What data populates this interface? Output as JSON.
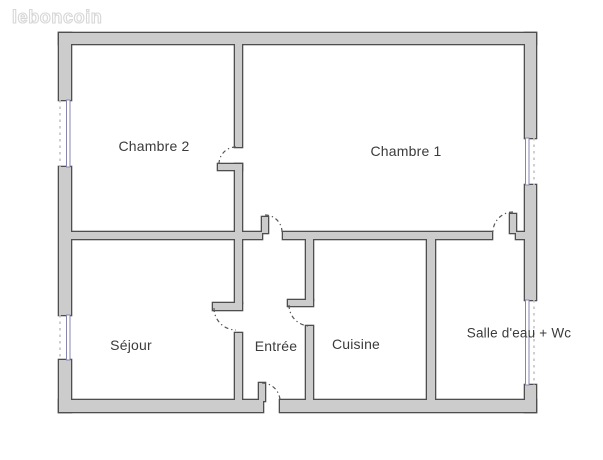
{
  "watermark": {
    "text": "leboncoin"
  },
  "colors": {
    "background": "#ffffff",
    "wall_fill": "#cccccc",
    "wall_stroke": "#4e4e4e",
    "window_line": "#8585b0",
    "window_dash": "#c3c3cb",
    "door_arc": "#555555",
    "label_text": "#3b3b3b"
  },
  "floorplan": {
    "canvas": {
      "width": 603,
      "height": 460
    },
    "rooms": [
      {
        "id": "chambre2",
        "label": "Chambre 2"
      },
      {
        "id": "chambre1",
        "label": "Chambre 1"
      },
      {
        "id": "sejour",
        "label": "Séjour"
      },
      {
        "id": "entree",
        "label": "Entrée"
      },
      {
        "id": "cuisine",
        "label": "Cuisine"
      },
      {
        "id": "salle-deau-wc",
        "label": "Salle d'eau + Wc"
      }
    ],
    "walls": [
      {
        "x": 59,
        "y": 33,
        "w": 477,
        "h": 11
      },
      {
        "x": 59,
        "y": 33,
        "w": 12,
        "h": 67
      },
      {
        "x": 59,
        "y": 167,
        "w": 12,
        "h": 148
      },
      {
        "x": 59,
        "y": 360,
        "w": 12,
        "h": 52
      },
      {
        "x": 525,
        "y": 33,
        "w": 11,
        "h": 105
      },
      {
        "x": 525,
        "y": 185,
        "w": 11,
        "h": 115
      },
      {
        "x": 525,
        "y": 385,
        "w": 11,
        "h": 27
      },
      {
        "x": 59,
        "y": 400,
        "w": 204,
        "h": 12
      },
      {
        "x": 280,
        "y": 400,
        "w": 256,
        "h": 12
      },
      {
        "x": 70,
        "y": 232,
        "w": 192,
        "h": 7
      },
      {
        "x": 283,
        "y": 232,
        "w": 209,
        "h": 7
      },
      {
        "x": 516,
        "y": 232,
        "w": 10,
        "h": 7
      },
      {
        "x": 235,
        "y": 43,
        "w": 7,
        "h": 104
      },
      {
        "x": 235,
        "y": 164,
        "w": 7,
        "h": 75
      },
      {
        "x": 235,
        "y": 238,
        "w": 7,
        "h": 65
      },
      {
        "x": 235,
        "y": 333,
        "w": 7,
        "h": 69
      },
      {
        "x": 306,
        "y": 238,
        "w": 7,
        "h": 62
      },
      {
        "x": 306,
        "y": 326,
        "w": 7,
        "h": 76
      },
      {
        "x": 427,
        "y": 238,
        "w": 8,
        "h": 164
      }
    ],
    "door_leaves": [
      {
        "x": 218,
        "y": 164,
        "w": 24,
        "h": 6
      },
      {
        "x": 262,
        "y": 217,
        "w": 6,
        "h": 16
      },
      {
        "x": 510,
        "y": 214,
        "w": 6,
        "h": 19
      },
      {
        "x": 213,
        "y": 303,
        "w": 29,
        "h": 7
      },
      {
        "x": 288,
        "y": 300,
        "w": 25,
        "h": 6
      },
      {
        "x": 259,
        "y": 383,
        "w": 6,
        "h": 18
      }
    ],
    "door_arcs": [
      "M 219 164 A 17 17 0 0 1 236 147",
      "M 265 215 A 17 17 0 0 1 282 232",
      "M 513 212 A 20 20 0 0 0 493 232",
      "M 214 308 A 22 22 0 0 0 236 330",
      "M 289 305 A 21 21 0 0 0 310 326",
      "M 262 383 A 18 18 0 0 1 280 401"
    ],
    "windows": [
      {
        "x": 66.5,
        "y": 100,
        "w": 3.5,
        "h": 67,
        "dash_x": 60
      },
      {
        "x": 66.5,
        "y": 315,
        "w": 3.5,
        "h": 45,
        "dash_x": 60
      },
      {
        "x": 525.5,
        "y": 138,
        "w": 3.5,
        "h": 47,
        "dash_x": 534
      },
      {
        "x": 525.5,
        "y": 300,
        "w": 3.5,
        "h": 85,
        "dash_x": 534
      }
    ]
  }
}
